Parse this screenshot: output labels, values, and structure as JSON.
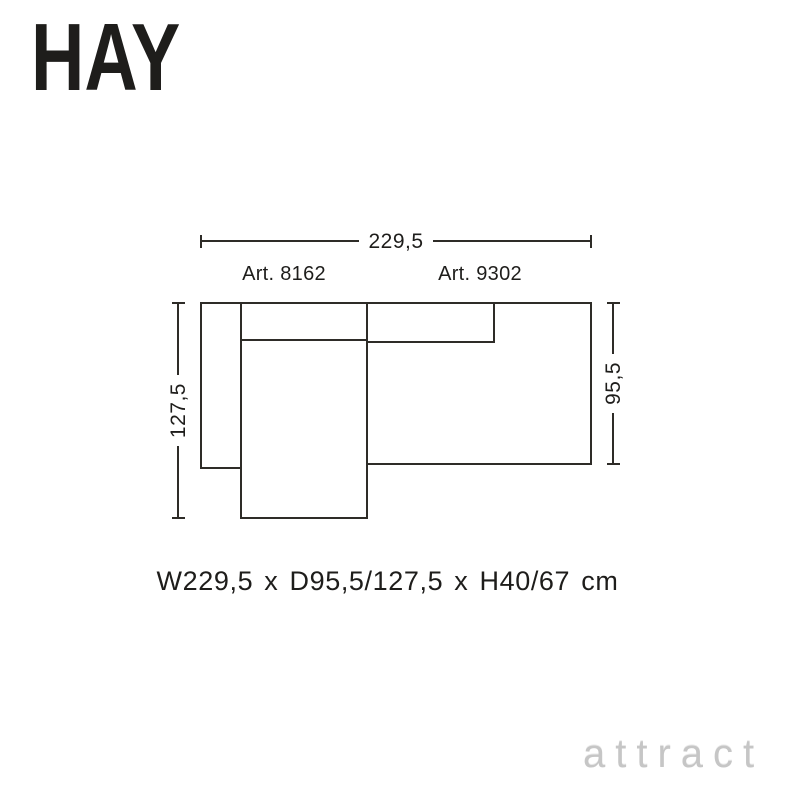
{
  "brand": {
    "logo_text": "HAY"
  },
  "diagram": {
    "width_dimension": "229,5",
    "left_depth_dimension": "127,5",
    "right_depth_dimension": "95,5",
    "modules": [
      {
        "article": "Art. 8162",
        "position": "left-chaise"
      },
      {
        "article": "Art. 9302",
        "position": "right"
      }
    ]
  },
  "summary": {
    "text": "W229,5 x D95,5/127,5 x H40/67 cm"
  },
  "watermark": {
    "text": "attract"
  },
  "colors": {
    "line": "#2e2c28",
    "text": "#1e1d1b",
    "watermark": "#c6c6c6",
    "background": "#ffffff"
  }
}
